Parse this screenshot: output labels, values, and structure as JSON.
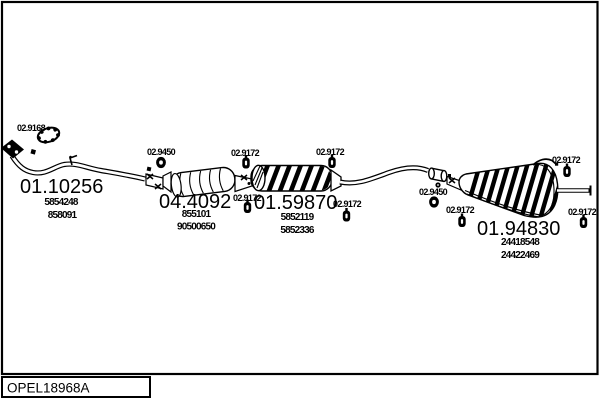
{
  "drawing": {
    "code": "OPEL18968A",
    "background_color": "#ffffff",
    "line_color": "#000000"
  },
  "assemblies": [
    {
      "part_number": "01.10256",
      "oem_refs": [
        "5854248",
        "858091"
      ]
    },
    {
      "part_number": "04.4092",
      "oem_refs": [
        "855101",
        "90500650"
      ]
    },
    {
      "part_number": "01.59870",
      "oem_refs": [
        "5852119",
        "5852336"
      ]
    },
    {
      "part_number": "01.94830",
      "oem_refs": [
        "24418548",
        "24422469"
      ]
    }
  ],
  "fittings": [
    {
      "part_number": "02.9168"
    },
    {
      "part_number": "02.9450"
    },
    {
      "part_number": "02.9172"
    },
    {
      "part_number": "02.9172"
    },
    {
      "part_number": "02.9172"
    },
    {
      "part_number": "02.9172"
    },
    {
      "part_number": "02.9450"
    },
    {
      "part_number": "02.9172"
    },
    {
      "part_number": "02.9172"
    },
    {
      "part_number": "02.9172"
    }
  ]
}
